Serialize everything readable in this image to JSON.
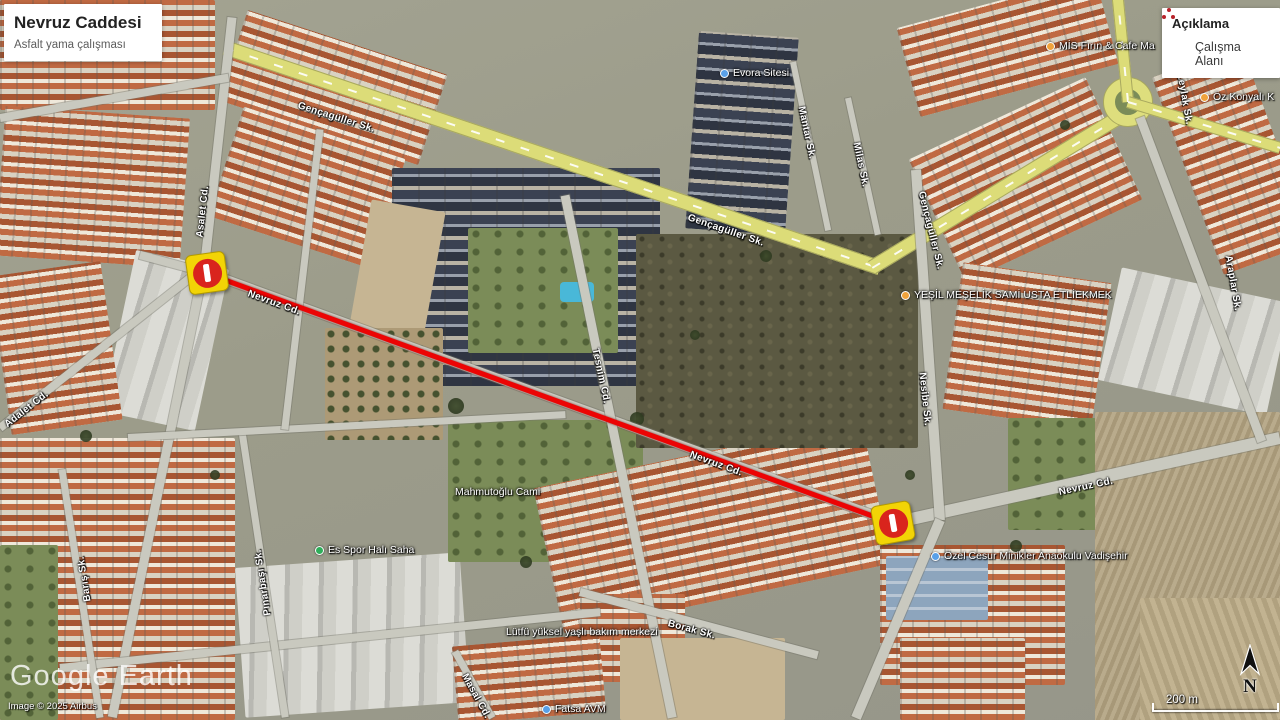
{
  "info_panel": {
    "title": "Nevruz Caddesi",
    "subtitle": "Asfalt yama çalışması"
  },
  "legend": {
    "title": "Açıklama",
    "items": [
      {
        "label": "Çalışma Alanı",
        "symbol": "red-dots-icon",
        "symbol_color": "#b8232a"
      }
    ]
  },
  "watermark": {
    "brand": "Google Earth",
    "copyright": "Image © 2025 Airbus"
  },
  "scale_bar": {
    "label": "200 m"
  },
  "compass": {
    "label": "N"
  },
  "work_zone": {
    "label": "Çalışma Alanı",
    "color": "#ec0404",
    "from": {
      "x": 207,
      "y": 273
    },
    "to": {
      "x": 893,
      "y": 523
    },
    "closure_icons": [
      {
        "x": 207,
        "y": 273,
        "rot": -8
      },
      {
        "x": 893,
        "y": 523,
        "rot": -10
      }
    ]
  },
  "street_labels": [
    {
      "text": "Gençagüller Sk.",
      "x": 298,
      "y": 100,
      "rot": 17.5
    },
    {
      "text": "Gençagüller Sk.",
      "x": 688,
      "y": 212,
      "rot": 19
    },
    {
      "text": "Gençagüller Sk.",
      "x": 921,
      "y": 186,
      "rot": 76
    },
    {
      "text": "Asalet Cd.",
      "x": 200,
      "y": 232,
      "rot": -83.7
    },
    {
      "text": "Adalet Cd.",
      "x": 6,
      "y": 420,
      "rot": -38
    },
    {
      "text": "Nevruz Cd.",
      "x": 248,
      "y": 288,
      "rot": 20
    },
    {
      "text": "Nevruz Cd.",
      "x": 690,
      "y": 449,
      "rot": 20
    },
    {
      "text": "Nevruz Cd.",
      "x": 1059,
      "y": 487,
      "rot": -12
    },
    {
      "text": "Tesnim Cd.",
      "x": 595,
      "y": 343,
      "rot": 78
    },
    {
      "text": "Nesibe Sk.",
      "x": 922,
      "y": 367,
      "rot": 84
    },
    {
      "text": "Mantar Sk.",
      "x": 801,
      "y": 101,
      "rot": 78
    },
    {
      "text": "Milas Sk.",
      "x": 856,
      "y": 137,
      "rot": 78
    },
    {
      "text": "Barış Sk.",
      "x": 88,
      "y": 596,
      "rot": -98.7
    },
    {
      "text": "Pınarbaşı Sk.",
      "x": 268,
      "y": 610,
      "rot": -98.6
    },
    {
      "text": "Borak Sk.",
      "x": 668,
      "y": 618,
      "rot": 15
    },
    {
      "text": "Masal Cd.",
      "x": 464,
      "y": 669,
      "rot": 61
    },
    {
      "text": "Leylak Sk.",
      "x": 1180,
      "y": 68,
      "rot": 80
    },
    {
      "text": "Araplar Sk.",
      "x": 1228,
      "y": 250,
      "rot": 80
    }
  ],
  "poi_labels": [
    {
      "text": "MİS Fırın & Cafe Ma",
      "x": 1046,
      "y": 40,
      "dot": "orange"
    },
    {
      "text": "Öz Konyalı K",
      "x": 1200,
      "y": 91,
      "dot": "orange"
    },
    {
      "text": "YEŞİL MEŞELİK SAMİ USTA ETLİEKMEK",
      "x": 901,
      "y": 289,
      "dot": "orange"
    },
    {
      "text": "Özel Cesur Minikler Anaokulu Vadişehir",
      "x": 931,
      "y": 550,
      "dot": "blue"
    },
    {
      "text": "Es Spor Halı Saha",
      "x": 315,
      "y": 544,
      "dot": "green"
    },
    {
      "text": "Mahmutoğlu Cami",
      "x": 455,
      "y": 486
    },
    {
      "text": "Evora Sitesi",
      "x": 720,
      "y": 67,
      "dot": "blue"
    },
    {
      "text": "Lütfü yüksel yaşlı bakım merkezi",
      "x": 506,
      "y": 626
    },
    {
      "text": "Fatsa AVM",
      "x": 542,
      "y": 703,
      "dot": "blue"
    }
  ]
}
